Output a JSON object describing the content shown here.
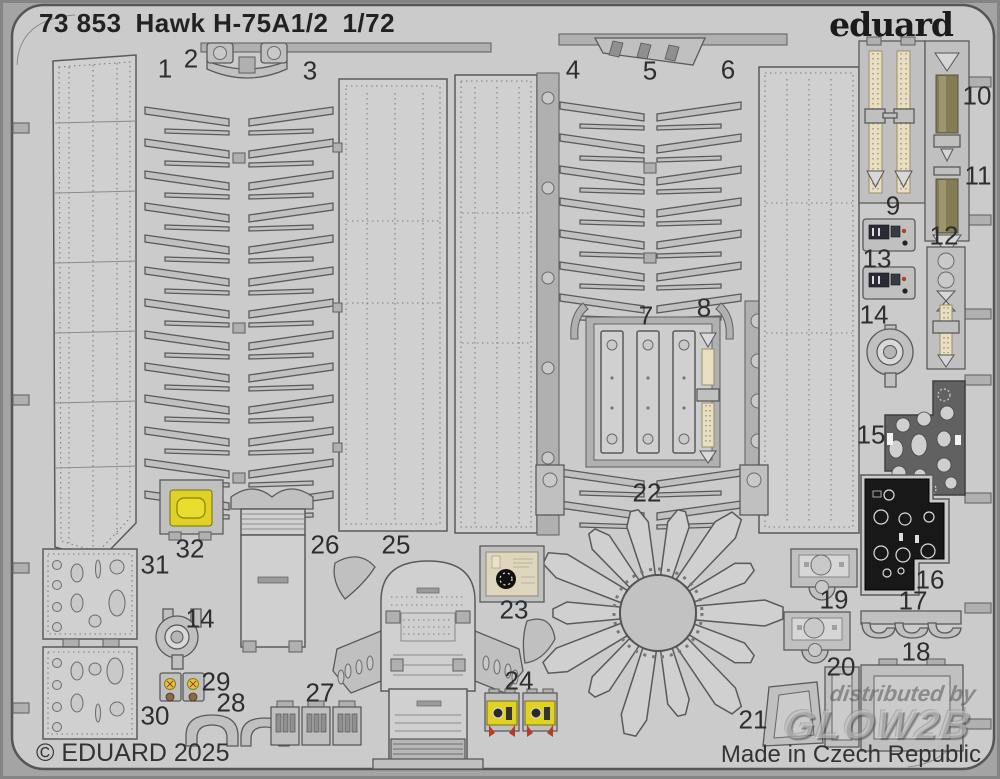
{
  "header": {
    "catalog_number": "73 853",
    "title": "Hawk H-75A1/2",
    "scale": "1/72",
    "brand_logo": "eduard"
  },
  "footer": {
    "copyright": "© EDUARD 2025",
    "origin": "Made in Czech Republic"
  },
  "watermark": {
    "line1": "distributed by",
    "line2": "GLOW2B"
  },
  "part_labels": [
    "1",
    "2",
    "3",
    "4",
    "5",
    "6",
    "7",
    "8",
    "9",
    "10",
    "11",
    "12",
    "13",
    "14",
    "15",
    "16",
    "17",
    "18",
    "19",
    "20",
    "21",
    "22",
    "23",
    "24",
    "25",
    "26",
    "27",
    "28",
    "29",
    "30",
    "31",
    "32",
    "14"
  ],
  "colors": {
    "photo_background": "#a4a4a4",
    "fret_metal": "#cbcbcb",
    "part_outline": "#5a5a5a",
    "seatbelt_cream": "#e9dfc0",
    "seatbelt_olive": "#847b57",
    "printed_yellow": "#e0d225",
    "printed_red": "#b23c2a",
    "instrument_panel_black": "#181818",
    "label_text": "#2e2e2e"
  }
}
